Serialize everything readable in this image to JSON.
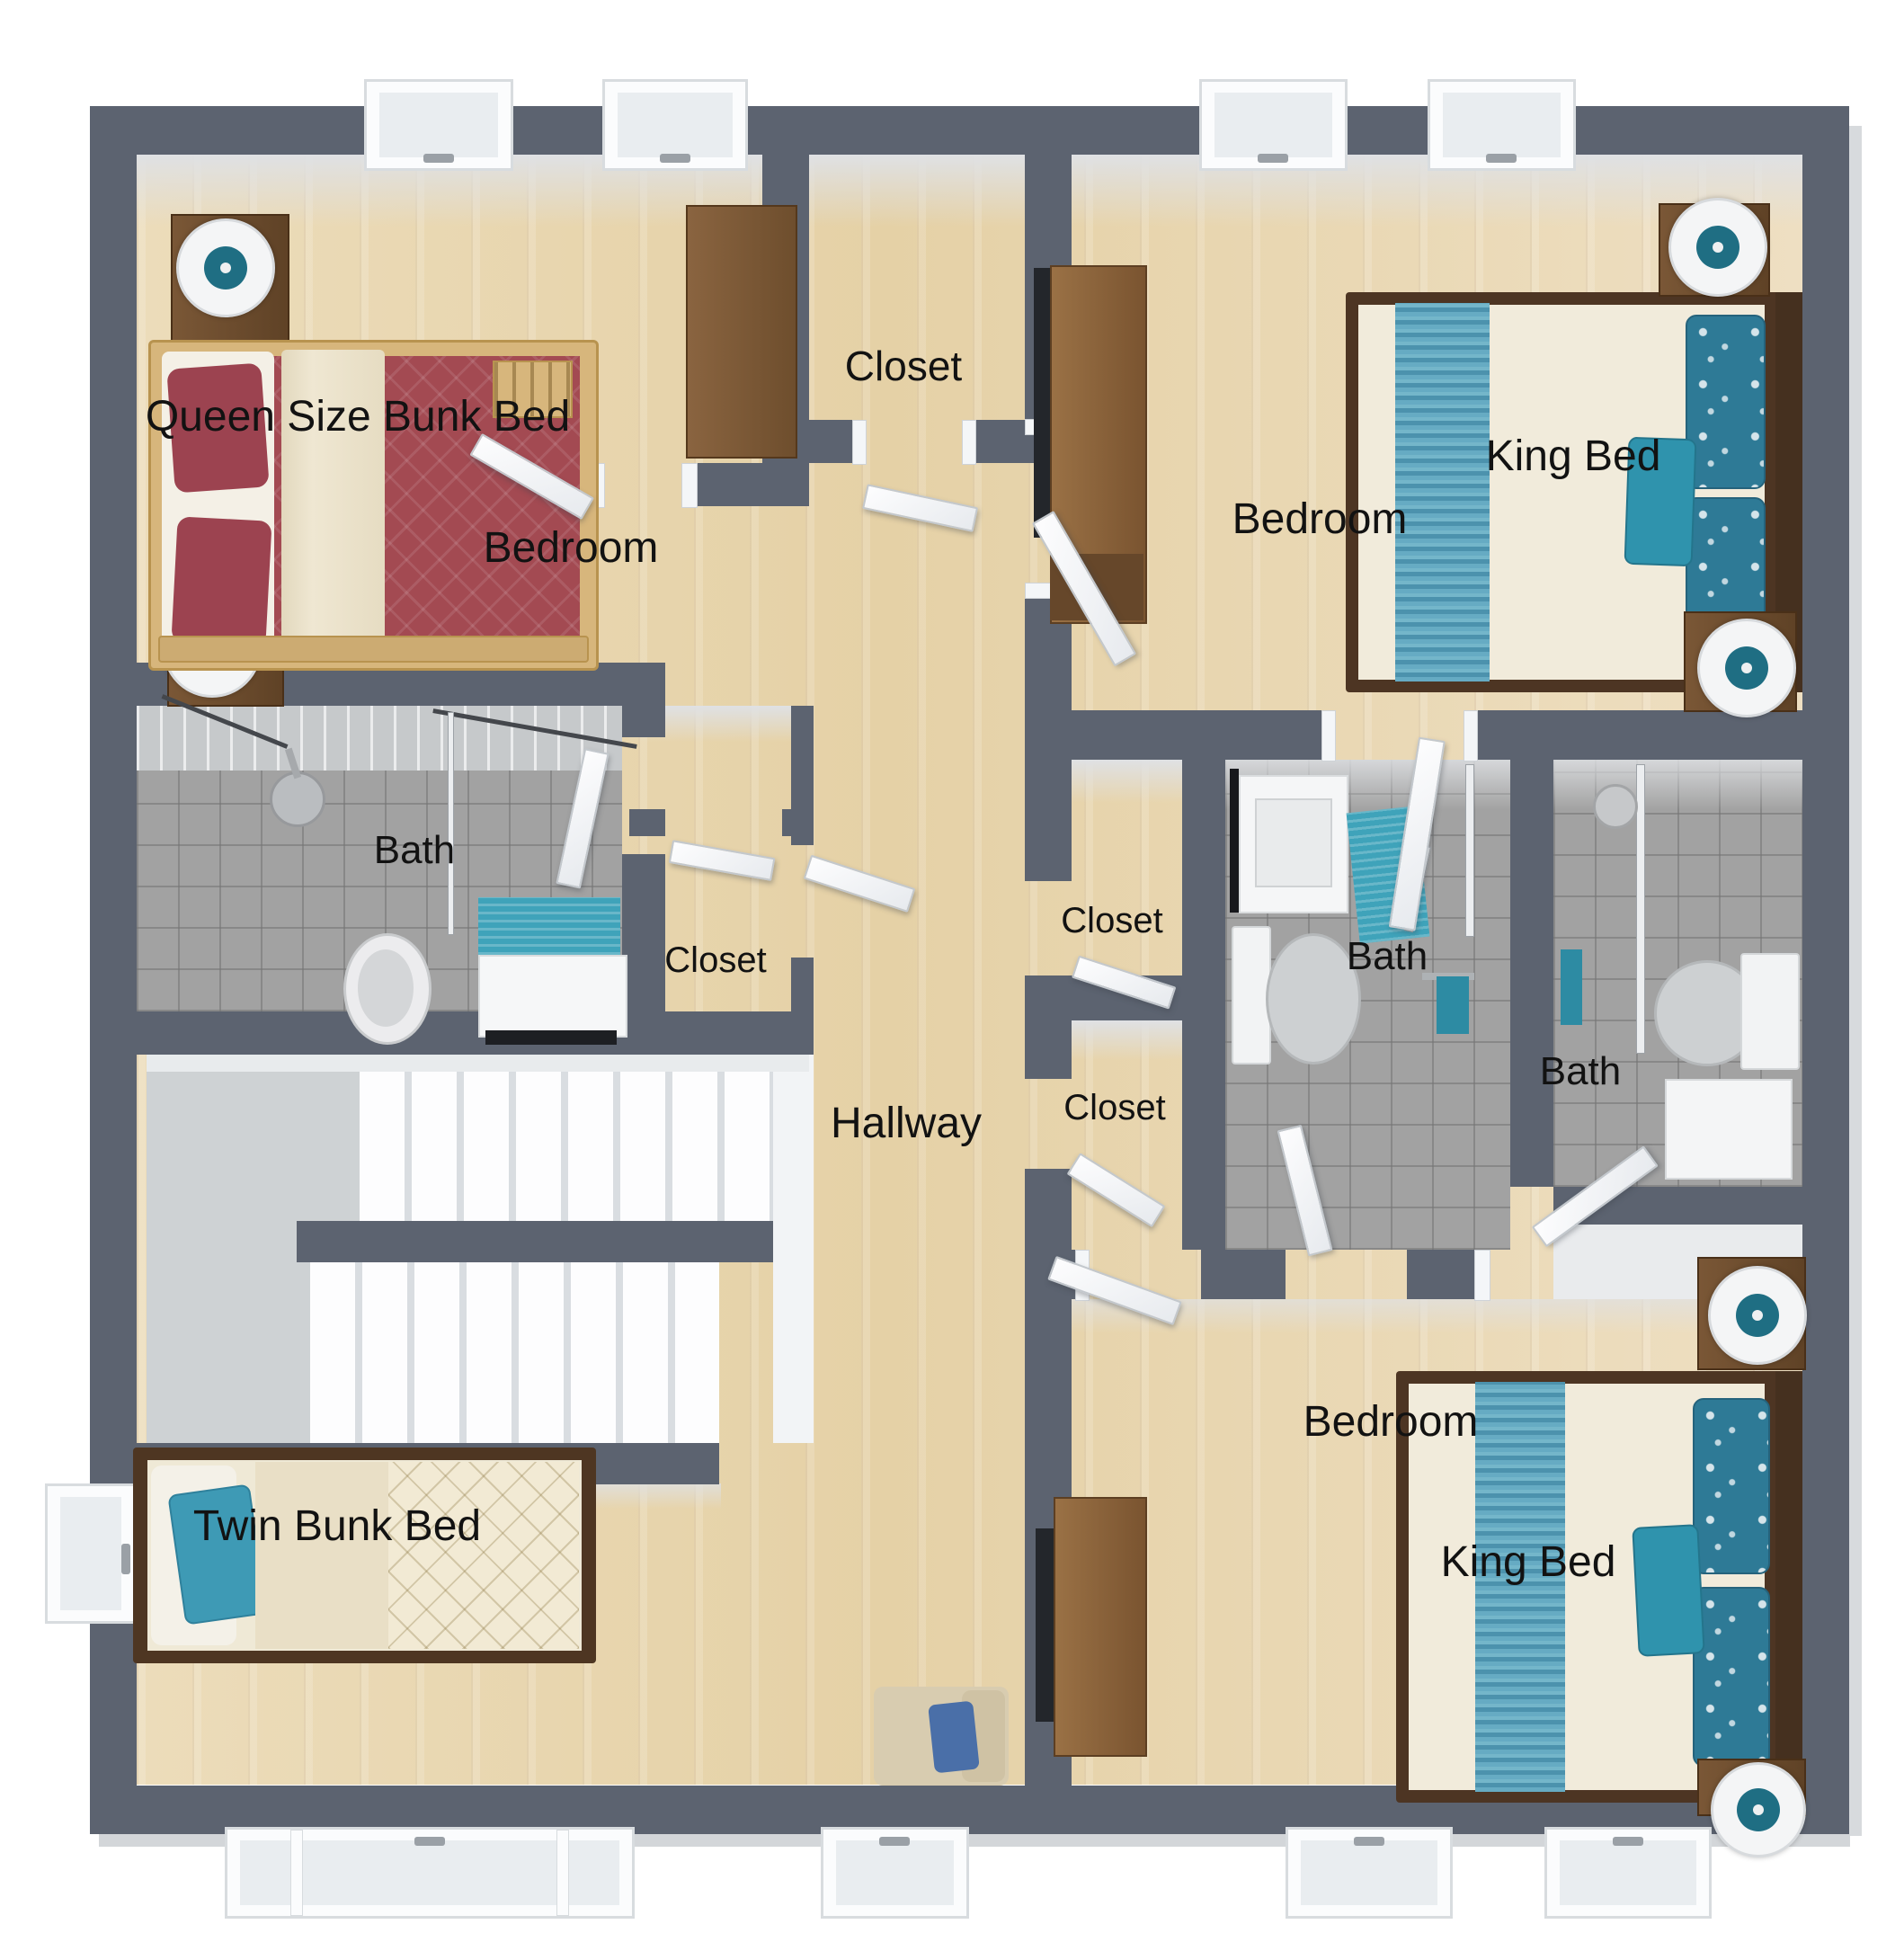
{
  "rooms": [
    {
      "id": "bedroom-top-left",
      "label": "Bedroom",
      "furniture": "Queen Size Bunk Bed"
    },
    {
      "id": "closet-top",
      "label": "Closet"
    },
    {
      "id": "bedroom-top-right",
      "label": "Bedroom",
      "furniture": "King Bed"
    },
    {
      "id": "bath-left",
      "label": "Bath"
    },
    {
      "id": "closet-hall",
      "label": "Closet"
    },
    {
      "id": "closet-right-upper",
      "label": "Closet"
    },
    {
      "id": "bath-middle",
      "label": "Bath"
    },
    {
      "id": "closet-right-lower",
      "label": "Closet"
    },
    {
      "id": "bath-right",
      "label": "Bath"
    },
    {
      "id": "hallway",
      "label": "Hallway"
    },
    {
      "id": "bedroom-bottom-left",
      "furniture": "Twin Bunk Bed"
    },
    {
      "id": "bedroom-bottom-right",
      "label": "Bedroom",
      "furniture": "King Bed"
    }
  ],
  "colors": {
    "wall": "#5c6370",
    "floor_wood": "#ead9b5",
    "bath_tile": "#a2a2a2",
    "accent_teal": "#3fa3ba",
    "bed_maroon": "#a34a52",
    "bed_cream": "#f1ebdb",
    "furniture_brown": "#6b4a2c",
    "stair_white": "#fafbfc"
  }
}
